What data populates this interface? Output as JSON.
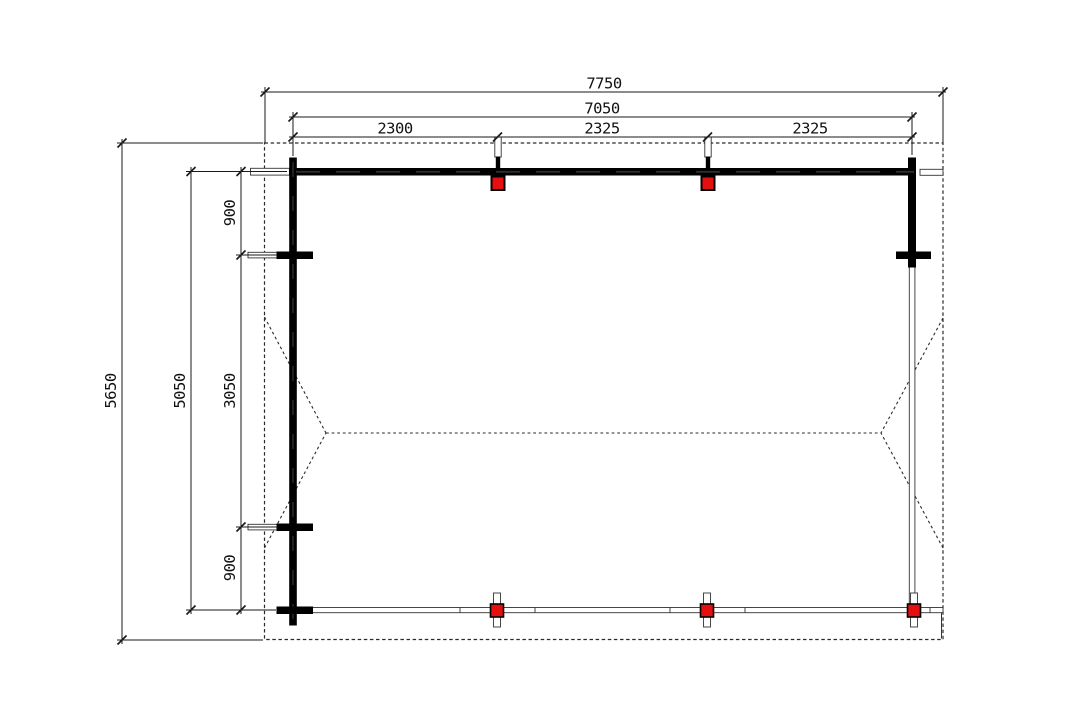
{
  "drawing": {
    "title": "carport-floor-plan",
    "dimensions_top": {
      "overall": "7750",
      "inner": "7050",
      "segments": [
        "2300",
        "2325",
        "2325"
      ]
    },
    "dimensions_left": {
      "overall": "5650",
      "inner": "5050",
      "segments": [
        "900",
        "3050",
        "900"
      ]
    },
    "colors": {
      "post_red": "#e60f0f",
      "wall_black": "#000000",
      "dim_line": "#1a1a1a",
      "dashed_line": "#2b2b2b"
    }
  }
}
